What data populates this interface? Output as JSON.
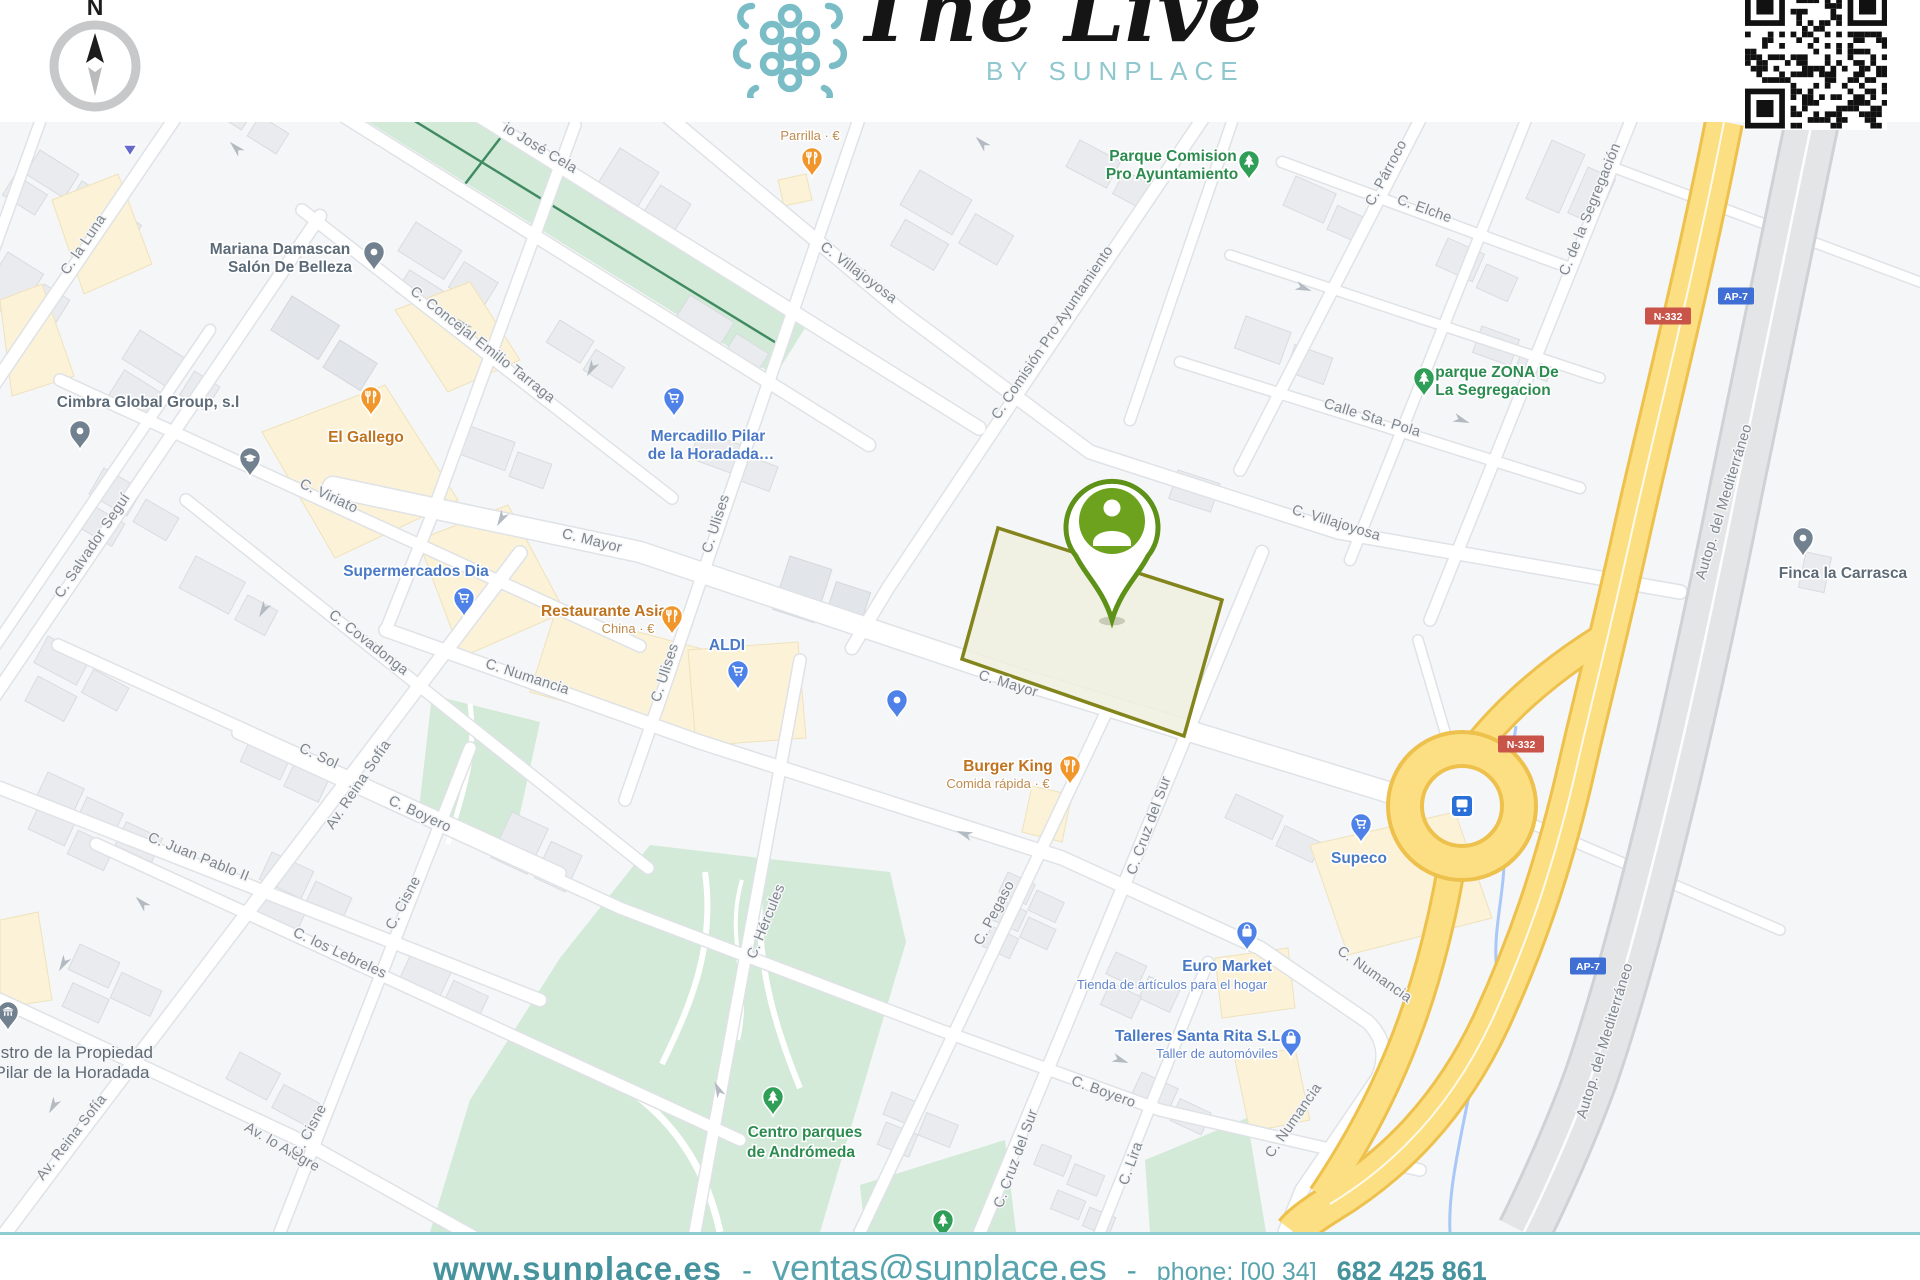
{
  "brand": {
    "title": "The Live",
    "subtitle": "BY SUNPLACE"
  },
  "compass": {
    "label": "N"
  },
  "footer": {
    "website": "www.sunplace.es",
    "sep": "-",
    "email": "ventas@sunplace.es",
    "phone_label": "phone: [00 34]",
    "phone": "682 425 861"
  },
  "colors": {
    "accent_teal": "#7abdc6",
    "property_pin_green": "#6da21f",
    "parcel_border_olive": "#83851c",
    "shield_red": "#c9544a",
    "shield_blue": "#3f6fd4"
  },
  "map": {
    "pin_colors": {
      "food": "#f0962b",
      "shop": "#4f82e8",
      "park": "#2f9e56",
      "gray": "#72818f",
      "tri": "#6569c9"
    },
    "label_colors": {
      "food": "#c0731f",
      "shop": "#4a79c6",
      "park": "#2c8c4f",
      "gray": "#5d6b78"
    },
    "sub_colors": {
      "food": "#c08a4e",
      "shop": "#6286cc",
      "park": "#4f9a6a",
      "gray": "#707e8c"
    },
    "street_labels": [
      [
        "C. la Luna",
        87,
        247,
        -56
      ],
      [
        "C. Salvador Seguí",
        96,
        548,
        -56
      ],
      [
        "C. Viriato",
        327,
        500,
        25
      ],
      [
        "C. Covadonga",
        366,
        646,
        38
      ],
      [
        "C. Sol",
        317,
        760,
        25
      ],
      [
        "Av. Reina Sofía",
        362,
        787,
        -56
      ],
      [
        "Av. Reina Sofía",
        75,
        1140,
        -52
      ],
      [
        "C. Juan Pablo II",
        197,
        861,
        22
      ],
      [
        "C. los Lebreles",
        338,
        957,
        25
      ],
      [
        "C. Boyero",
        418,
        818,
        25
      ],
      [
        "Av. lo Alegre",
        280,
        1151,
        30
      ],
      [
        "C. Cisne",
        407,
        905,
        -62
      ],
      [
        "C. Cisne",
        313,
        1133,
        -62
      ],
      [
        "C. Hércules",
        770,
        923,
        -68
      ],
      [
        "C. Numancia",
        526,
        681,
        18
      ],
      [
        "C. Numancia",
        1372,
        978,
        35
      ],
      [
        "C. Numancia",
        1297,
        1123,
        -55
      ],
      [
        "C. Pegaso",
        998,
        915,
        -62
      ],
      [
        "C. Cruz del Sur",
        1153,
        827,
        -70
      ],
      [
        "C. Cruz del Sur",
        1020,
        1160,
        -70
      ],
      [
        "C. Lira",
        1135,
        1165,
        -70
      ],
      [
        "C. Boyero",
        1102,
        1096,
        20
      ],
      [
        "C. Mayor",
        591,
        545,
        14
      ],
      [
        "C. Mayor",
        1007,
        688,
        17
      ],
      [
        "C. Ulises",
        720,
        525,
        -72
      ],
      [
        "C. Ulises",
        669,
        674,
        -72
      ],
      [
        "C. Concejal Emilio Tarraga",
        480,
        348,
        38
      ],
      [
        "C. Villajoyosa",
        856,
        276,
        37
      ],
      [
        "C. Comisión Pro Ayuntamiento",
        1056,
        335,
        -56
      ],
      [
        "C. Villajoyosa",
        1335,
        527,
        17
      ],
      [
        "C. Párroco",
        1390,
        175,
        -62
      ],
      [
        "C. Elche",
        1423,
        213,
        20
      ],
      [
        "C. de la Segregación",
        1594,
        211,
        -68
      ],
      [
        "Calle Sta. Pola",
        1371,
        422,
        17
      ],
      [
        "Autop. del Mediterráneo",
        1728,
        503,
        -73
      ],
      [
        "Autop. del Mediterráneo",
        1609,
        1042,
        -73
      ],
      [
        "io José Cela",
        538,
        152,
        31
      ]
    ],
    "shields": [
      [
        "N-332",
        "red",
        1668,
        316
      ],
      [
        "AP-7",
        "blue",
        1736,
        296
      ],
      [
        "N-332",
        "red",
        1521,
        744
      ],
      [
        "AP-7",
        "blue",
        1588,
        966
      ]
    ],
    "arrows": [
      [
        234,
        146,
        225
      ],
      [
        462,
        323,
        225
      ],
      [
        500,
        521,
        120
      ],
      [
        262,
        612,
        120
      ],
      [
        352,
        793,
        120
      ],
      [
        140,
        901,
        225
      ],
      [
        62,
        966,
        120
      ],
      [
        980,
        141,
        225
      ],
      [
        1306,
        289,
        20
      ],
      [
        1464,
        421,
        20
      ],
      [
        962,
        833,
        200
      ],
      [
        717,
        1087,
        245
      ],
      [
        1123,
        1061,
        20
      ],
      [
        52,
        1108,
        120
      ],
      [
        590,
        371,
        120
      ]
    ],
    "pois": [
      {
        "k": "food",
        "g": "fork",
        "x": 812,
        "y": 158,
        "l": [
          [
            "Parrilla · €",
            810,
            140,
            0
          ]
        ]
      },
      {
        "k": "food",
        "g": "fork",
        "x": 371,
        "y": 397,
        "l": [
          [
            "El Gallego",
            366,
            442,
            1
          ]
        ]
      },
      {
        "k": "food",
        "g": "fork",
        "x": 672,
        "y": 616,
        "l": [
          [
            "Restaurante Asia",
            604,
            616,
            1
          ],
          [
            "China · €",
            628,
            633,
            0
          ]
        ]
      },
      {
        "k": "food",
        "g": "fork",
        "x": 1070,
        "y": 766,
        "l": [
          [
            "Burger King",
            1008,
            771,
            1
          ],
          [
            "Comida rápida · €",
            998,
            788,
            0
          ]
        ]
      },
      {
        "k": "shop",
        "g": "cart",
        "x": 674,
        "y": 398,
        "l": [
          [
            "Mercadillo Pilar",
            708,
            441,
            1
          ],
          [
            "de la Horadada…",
            711,
            459,
            1
          ]
        ]
      },
      {
        "k": "shop",
        "g": "cart",
        "x": 464,
        "y": 598,
        "l": [
          [
            "Supermercados Dia",
            416,
            576,
            1
          ]
        ]
      },
      {
        "k": "shop",
        "g": "cart",
        "x": 738,
        "y": 671,
        "l": [
          [
            "ALDI",
            727,
            650,
            1
          ]
        ]
      },
      {
        "k": "shop",
        "g": "cart",
        "x": 1361,
        "y": 824,
        "l": [
          [
            "Supeco",
            1359,
            863,
            1
          ]
        ]
      },
      {
        "k": "shop",
        "g": "bag",
        "x": 1247,
        "y": 932,
        "l": [
          [
            "Euro Market",
            1227,
            971,
            1
          ],
          [
            "Tienda de artículos para el hogar",
            1172,
            989,
            0
          ]
        ]
      },
      {
        "k": "shop",
        "g": "bag",
        "x": 1291,
        "y": 1039,
        "l": [
          [
            "Talleres Santa Rita S.L",
            1198,
            1041,
            1
          ],
          [
            "Taller de automóviles",
            1217,
            1058,
            0
          ]
        ]
      },
      {
        "k": "shop",
        "g": "dot",
        "x": 897,
        "y": 700,
        "l": []
      },
      {
        "k": "park",
        "g": "tree",
        "x": 1249,
        "y": 161,
        "l": [
          [
            "Parque Comision",
            1173,
            161,
            1
          ],
          [
            "Pro Ayuntamiento",
            1172,
            179,
            1
          ]
        ]
      },
      {
        "k": "park",
        "g": "tree",
        "x": 1424,
        "y": 378,
        "l": [
          [
            "parque ZONA De",
            1497,
            377,
            1
          ],
          [
            "La Segregacion",
            1493,
            395,
            1
          ]
        ]
      },
      {
        "k": "park",
        "g": "tree",
        "x": 773,
        "y": 1097,
        "l": [
          [
            "Centro parques",
            805,
            1137,
            1
          ],
          [
            "de Andrómeda",
            801,
            1157,
            1
          ]
        ]
      },
      {
        "k": "park",
        "g": "tree",
        "x": 943,
        "y": 1220,
        "l": []
      },
      {
        "k": "gray",
        "g": "dot",
        "x": 374,
        "y": 252,
        "l": [
          [
            "Mariana Damascan",
            280,
            254,
            1
          ],
          [
            "Salón De Belleza",
            290,
            272,
            1
          ]
        ]
      },
      {
        "k": "gray",
        "g": "dot",
        "x": 80,
        "y": 431,
        "l": [
          [
            "Cimbra Global Group, s.l",
            148,
            407,
            1
          ]
        ]
      },
      {
        "k": "gray",
        "g": "cap",
        "x": 250,
        "y": 458,
        "l": []
      },
      {
        "k": "gray",
        "g": "dot",
        "x": 1803,
        "y": 538,
        "l": [
          [
            "Finca la Carrasca",
            1843,
            578,
            1
          ]
        ]
      },
      {
        "k": "gray",
        "g": "bank",
        "x": 8,
        "y": 1012,
        "l": [
          [
            "istro de la Propiedad",
            75,
            1058,
            2
          ],
          [
            "Pilar de la Horadada",
            72,
            1078,
            2
          ]
        ]
      },
      {
        "k": "tri",
        "g": "tri",
        "x": 130,
        "y": 150,
        "l": []
      }
    ]
  }
}
